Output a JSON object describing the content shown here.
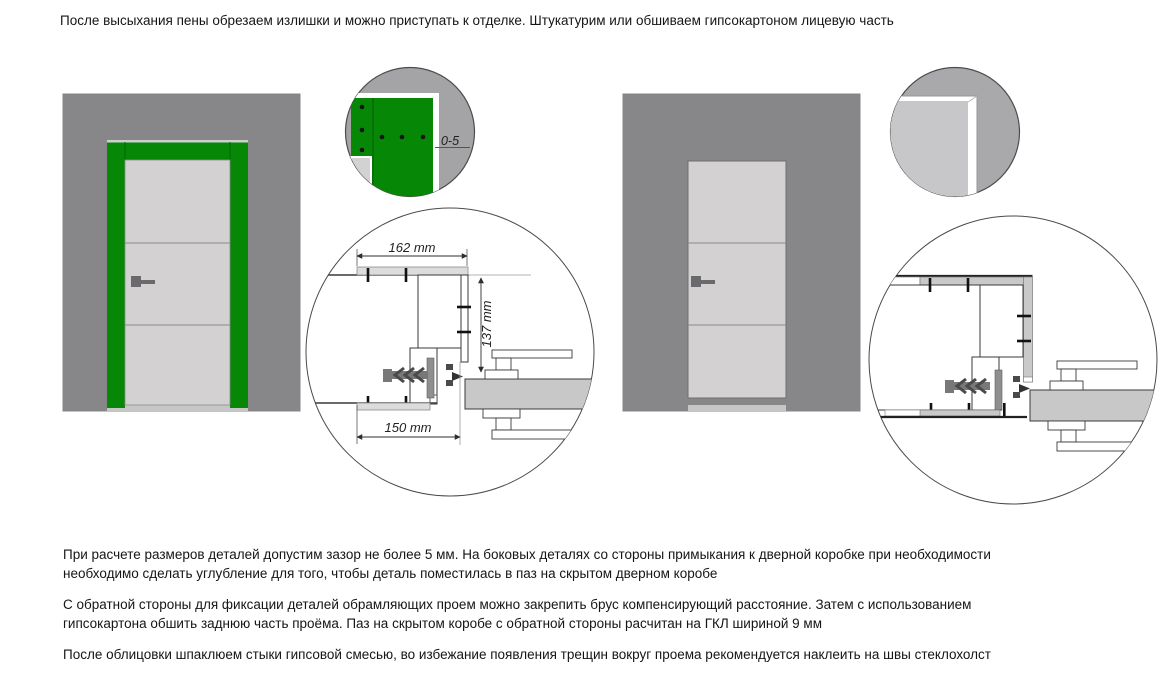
{
  "caption": "После высыхания пены обрезаем излишки и можно приступать к отделке. Штукатурим или обшиваем гипсокартоном лицевую часть",
  "paragraphs": {
    "p1l1": "При расчете размеров деталей допустим зазор не более 5 мм. На боковых деталях со стороны примыкания к дверной коробке при необходимости",
    "p1l2": "необходимо сделать углубление для того, чтобы деталь поместилась в паз на скрытом дверном коробе",
    "p2l1": "С обратной стороны для фиксации деталей обрамляющих проем можно закрепить брус компенсирующий расстояние. Затем с использованием",
    "p2l2": "гипсокартона обшить заднюю часть проёма. Паз на скрытом коробе с обратной стороны расчитан на ГКЛ шириной 9 мм",
    "p3": "После облицовки шпаклюем стыки гипсовой смесью, во избежание появления трещин вокруг проема рекомендуется наклеить на швы стеклохолст"
  },
  "dimensions": {
    "top_width": "162 mm",
    "side_height": "137 mm",
    "bottom_width": "150 mm",
    "corner_gap": "0-5"
  },
  "colors": {
    "wall": "#87878a",
    "frame_green": "#068806",
    "door_leaf": "#d3d1d2",
    "floor": "#c6c6c7",
    "handle": "#6a6a6e",
    "drywall": "#c9c9c9",
    "section_door": "#c8c8c8",
    "clad_strip": "#dcdcdc",
    "detail_bg_left": "#a4a4a6",
    "detail_bg_right": "#a9a9ab",
    "detail_light": "#c7c7c9"
  }
}
